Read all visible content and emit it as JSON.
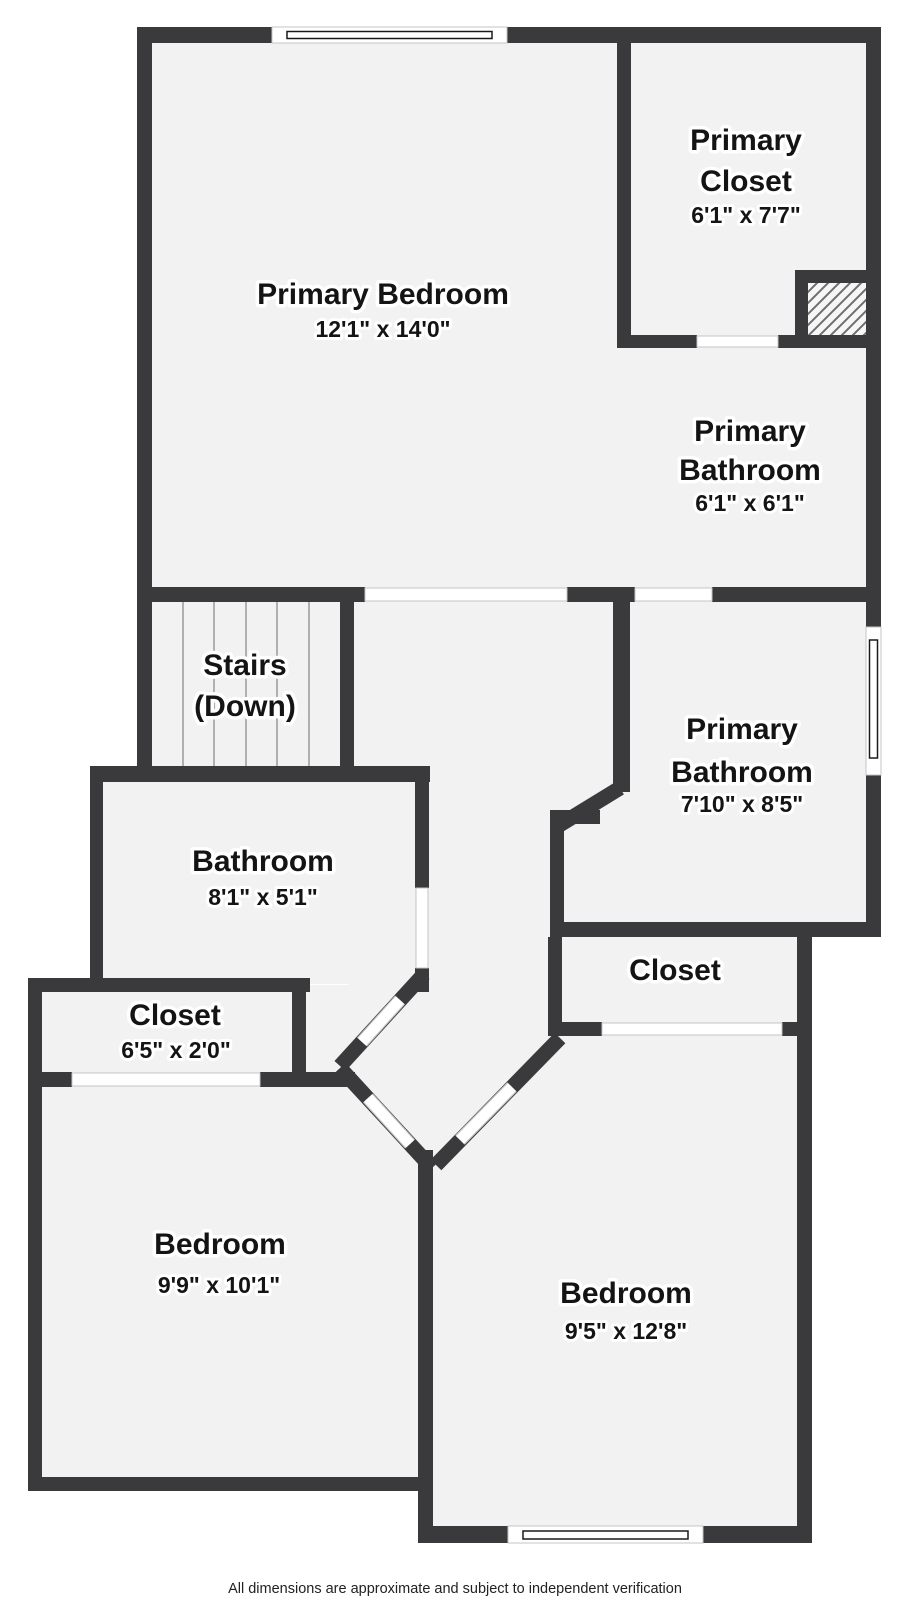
{
  "rooms": [
    {
      "id": "primary-bedroom",
      "name_lines": [
        "Primary Bedroom"
      ],
      "dims": "12'1\" x 14'0\""
    },
    {
      "id": "primary-closet",
      "name_lines": [
        "Primary",
        "Closet"
      ],
      "dims": "6'1\" x 7'7\""
    },
    {
      "id": "primary-bathroom-upper",
      "name_lines": [
        "Primary",
        "Bathroom"
      ],
      "dims": "6'1\" x 6'1\""
    },
    {
      "id": "stairs",
      "name_lines": [
        "Stairs",
        "(Down)"
      ],
      "dims": ""
    },
    {
      "id": "primary-bathroom-lower",
      "name_lines": [
        "Primary",
        "Bathroom"
      ],
      "dims": "7'10\" x 8'5\""
    },
    {
      "id": "bathroom",
      "name_lines": [
        "Bathroom"
      ],
      "dims": "8'1\" x 5'1\""
    },
    {
      "id": "closet-left",
      "name_lines": [
        "Closet"
      ],
      "dims": "6'5\" x 2'0\""
    },
    {
      "id": "closet-right",
      "name_lines": [
        "Closet"
      ],
      "dims": ""
    },
    {
      "id": "bedroom-left",
      "name_lines": [
        "Bedroom"
      ],
      "dims": "9'9\" x 10'1\""
    },
    {
      "id": "bedroom-right",
      "name_lines": [
        "Bedroom"
      ],
      "dims": "9'5\" x 12'8\""
    }
  ],
  "footer": {
    "text": "All dimensions are approximate and subject to independent verification"
  },
  "symbols": {
    "window": "double-line-window",
    "door": "white-wall-opening",
    "hatched_area": "diagonal-hatch-chase",
    "stairs": "parallel-tread-lines"
  },
  "colors": {
    "wall": "#3a3a3c",
    "floor": "#f2f2f2",
    "background": "#ffffff",
    "label_text": "#141414",
    "label_halo": "#ffffff",
    "stair_tread": "#9a9a9a",
    "hatch_line": "#6e6e6e",
    "hatch_fill": "#f6f6f6",
    "opening_frame": "#c4c4c4",
    "window_glazing": "#1a1a1a",
    "footer_text": "#222222"
  }
}
